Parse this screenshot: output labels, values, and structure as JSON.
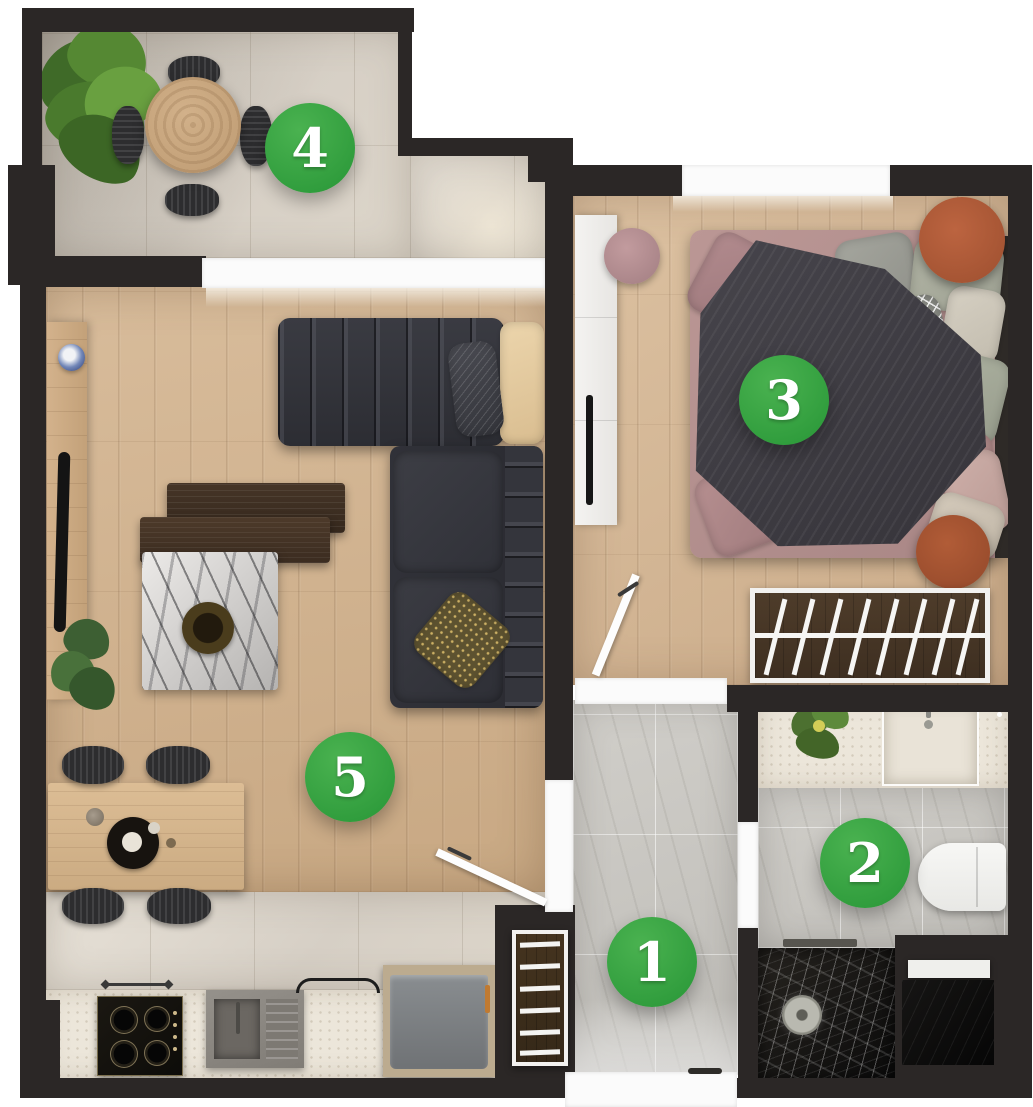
{
  "floorplan": {
    "markers": [
      {
        "label": "1"
      },
      {
        "label": "2"
      },
      {
        "label": "3"
      },
      {
        "label": "4"
      },
      {
        "label": "5"
      }
    ],
    "palette": {
      "outside": "#ffffff",
      "wall": "#2b2726",
      "marker_green": "#3aa540",
      "marker_text": "#ffffff",
      "wood_floor": "#cfae8c",
      "gray_tile": "#c6c4bf",
      "balcony_tile": "#d9d3ca",
      "counter_stone": "#ece6da",
      "sofa_charcoal": "#33343a",
      "terracotta": "#b2593a",
      "bed_mauve": "#b18e8d",
      "blanket_charcoal": "#3f3d43",
      "shower_black_marble": "#141312",
      "plant_green": "#55803a"
    }
  }
}
